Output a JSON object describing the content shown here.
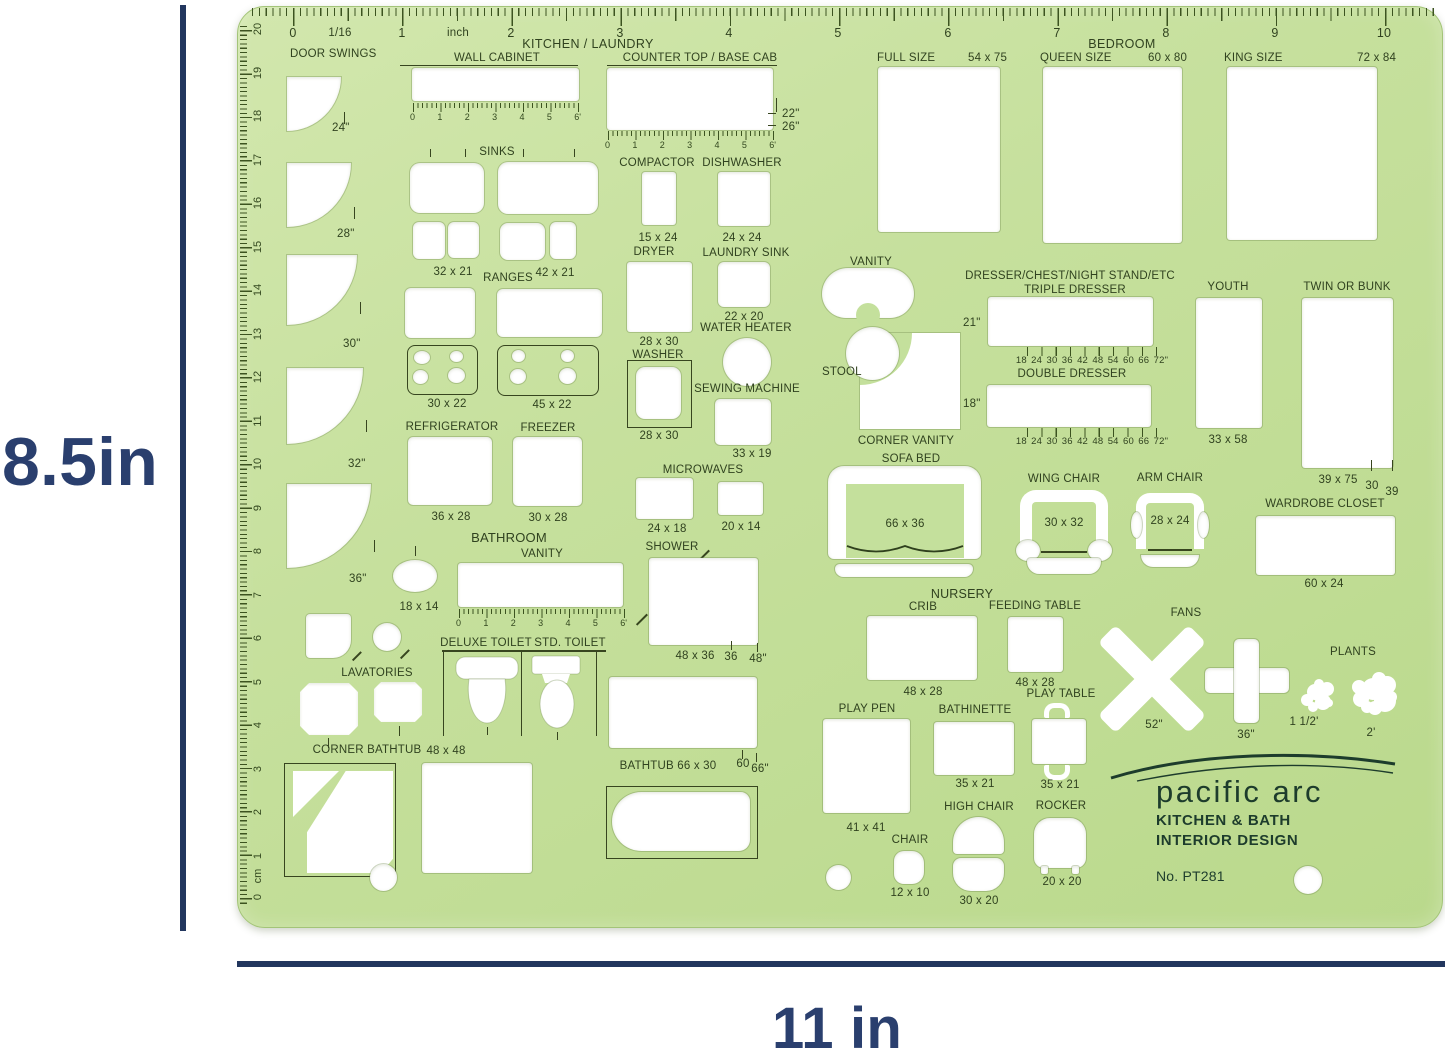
{
  "annotations": {
    "height_label": "8.5in",
    "width_label": "11 in",
    "accent_color": "#2a3f6e"
  },
  "template": {
    "material_color": "#c4e09c",
    "headers": {
      "kitchen": "KITCHEN / LAUNDRY",
      "bedroom": "BEDROOM",
      "bathroom": "BATHROOM",
      "nursery": "NURSERY"
    },
    "top_ruler": {
      "n0": "0",
      "f16": "1/16",
      "n1": "1",
      "inch": "inch",
      "n2": "2",
      "n3": "3",
      "n4": "4",
      "n5": "5",
      "n6": "6",
      "n7": "7",
      "n8": "8",
      "n9": "9",
      "n10": "10"
    },
    "cm_ruler": {
      "c20": "20",
      "c19": "19",
      "c18": "18",
      "c17": "17",
      "c16": "16",
      "c15": "15",
      "c14": "14",
      "c13": "13",
      "c12": "12",
      "c11": "11",
      "c10": "10",
      "c9": "9",
      "c8": "8",
      "c7": "7",
      "c6": "6",
      "c5": "5",
      "c4": "4",
      "c3": "3",
      "c2": "2",
      "c1": "1",
      "unit": "cm",
      "c0": "0"
    },
    "ft_ruler": {
      "f0": "0",
      "f1": "1",
      "f2": "2",
      "f3": "3",
      "f4": "4",
      "f5": "5",
      "f6": "6'"
    },
    "door_swings": {
      "label": "DOOR SWINGS",
      "s1": "24\"",
      "s2": "28\"",
      "s3": "30\"",
      "s4": "32\"",
      "s5": "36\""
    },
    "wall_cabinet": {
      "label": "WALL CABINET"
    },
    "counter_top": {
      "label": "COUNTER TOP / BASE CAB",
      "d1": "22\"",
      "d2": "26\""
    },
    "sinks": {
      "label": "SINKS",
      "size1": "32 x 21",
      "size2": "42 x 21"
    },
    "compactor": {
      "label": "COMPACTOR",
      "size": "15 x 24"
    },
    "dishwasher": {
      "label": "DISHWASHER",
      "size": "24 x 24"
    },
    "ranges": {
      "label": "RANGES",
      "size1": "30 x 22",
      "size2": "45 x 22"
    },
    "dryer": {
      "label": "DRYER",
      "size": "28 x 30"
    },
    "laundry_sink": {
      "label": "LAUNDRY SINK",
      "size": "22 x 20"
    },
    "water_heater": {
      "label": "WATER HEATER"
    },
    "washer": {
      "label": "WASHER",
      "size": "28 x 30"
    },
    "sewing_machine": {
      "label": "SEWING MACHINE",
      "size": "33 x 19"
    },
    "refrigerator": {
      "label": "REFRIGERATOR",
      "size": "36 x 28"
    },
    "freezer": {
      "label": "FREEZER",
      "size": "30 x 28"
    },
    "microwaves": {
      "label": "MICROWAVES",
      "size1": "24 x 18",
      "size2": "20 x 14"
    },
    "bath_vanity": {
      "label": "VANITY",
      "size": "18 x 14"
    },
    "shower": {
      "label": "SHOWER",
      "size": "48 x 36",
      "w": "36",
      "d": "48\""
    },
    "deluxe_toilet": {
      "label": "DELUXE TOILET"
    },
    "std_toilet": {
      "label": "STD. TOILET"
    },
    "lavatories": {
      "label": "LAVATORIES"
    },
    "corner_bathtub": {
      "label": "CORNER BATHTUB",
      "size": "48 x 48"
    },
    "bathtub": {
      "label": "BATHTUB  66 x 30",
      "t60": "60",
      "t66": "66\""
    },
    "full_bed": {
      "label": "FULL SIZE",
      "size": "54 x 75"
    },
    "queen_bed": {
      "label": "QUEEN SIZE",
      "size": "60 x 80"
    },
    "king_bed": {
      "label": "KING SIZE",
      "size": "72 x 84"
    },
    "bed_vanity": {
      "label": "VANITY"
    },
    "stool": {
      "label": "STOOL"
    },
    "corner_vanity": {
      "label": "CORNER VANITY"
    },
    "sofa_bed": {
      "label": "SOFA BED",
      "size": "66 x 36"
    },
    "dressers": {
      "header": "DRESSER/CHEST/NIGHT STAND/ETC",
      "triple": "TRIPLE DRESSER",
      "double": "DOUBLE DRESSER",
      "depth_triple": "21\"",
      "depth_double": "18\"",
      "ticks": "18 24 30 36 42 48 54 60 66 72\""
    },
    "youth_bed": {
      "label": "YOUTH",
      "size": "33 x 58"
    },
    "twin_bed": {
      "label": "TWIN OR BUNK",
      "size": "39 x 75",
      "t30": "30",
      "t39": "39"
    },
    "wardrobe": {
      "label": "WARDROBE CLOSET",
      "size": "60 x 24"
    },
    "wing_chair": {
      "label": "WING CHAIR",
      "size": "30 x 32"
    },
    "arm_chair": {
      "label": "ARM CHAIR",
      "size": "28 x 24"
    },
    "crib": {
      "label": "CRIB",
      "size": "48 x 28"
    },
    "feeding_table": {
      "label": "FEEDING TABLE",
      "size": "48 x 28"
    },
    "play_pen": {
      "label": "PLAY PEN",
      "size": "41 x 41"
    },
    "bathinette": {
      "label": "BATHINETTE",
      "size": "35 x 21"
    },
    "play_table": {
      "label": "PLAY TABLE",
      "size": "35 x 21"
    },
    "high_chair": {
      "label": "HIGH CHAIR",
      "size": "30 x 20"
    },
    "rocker": {
      "label": "ROCKER",
      "size": "20 x 20"
    },
    "chair": {
      "label": "CHAIR",
      "size": "12 x 10"
    },
    "fans": {
      "label": "FANS",
      "size1": "52\"",
      "size2": "36\""
    },
    "plants": {
      "label": "PLANTS",
      "size1": "1 1/2'",
      "size2": "2'"
    },
    "brand": {
      "name": "pacific arc",
      "line1": "KITCHEN & BATH",
      "line2": "INTERIOR DESIGN",
      "model": "No. PT281"
    }
  }
}
